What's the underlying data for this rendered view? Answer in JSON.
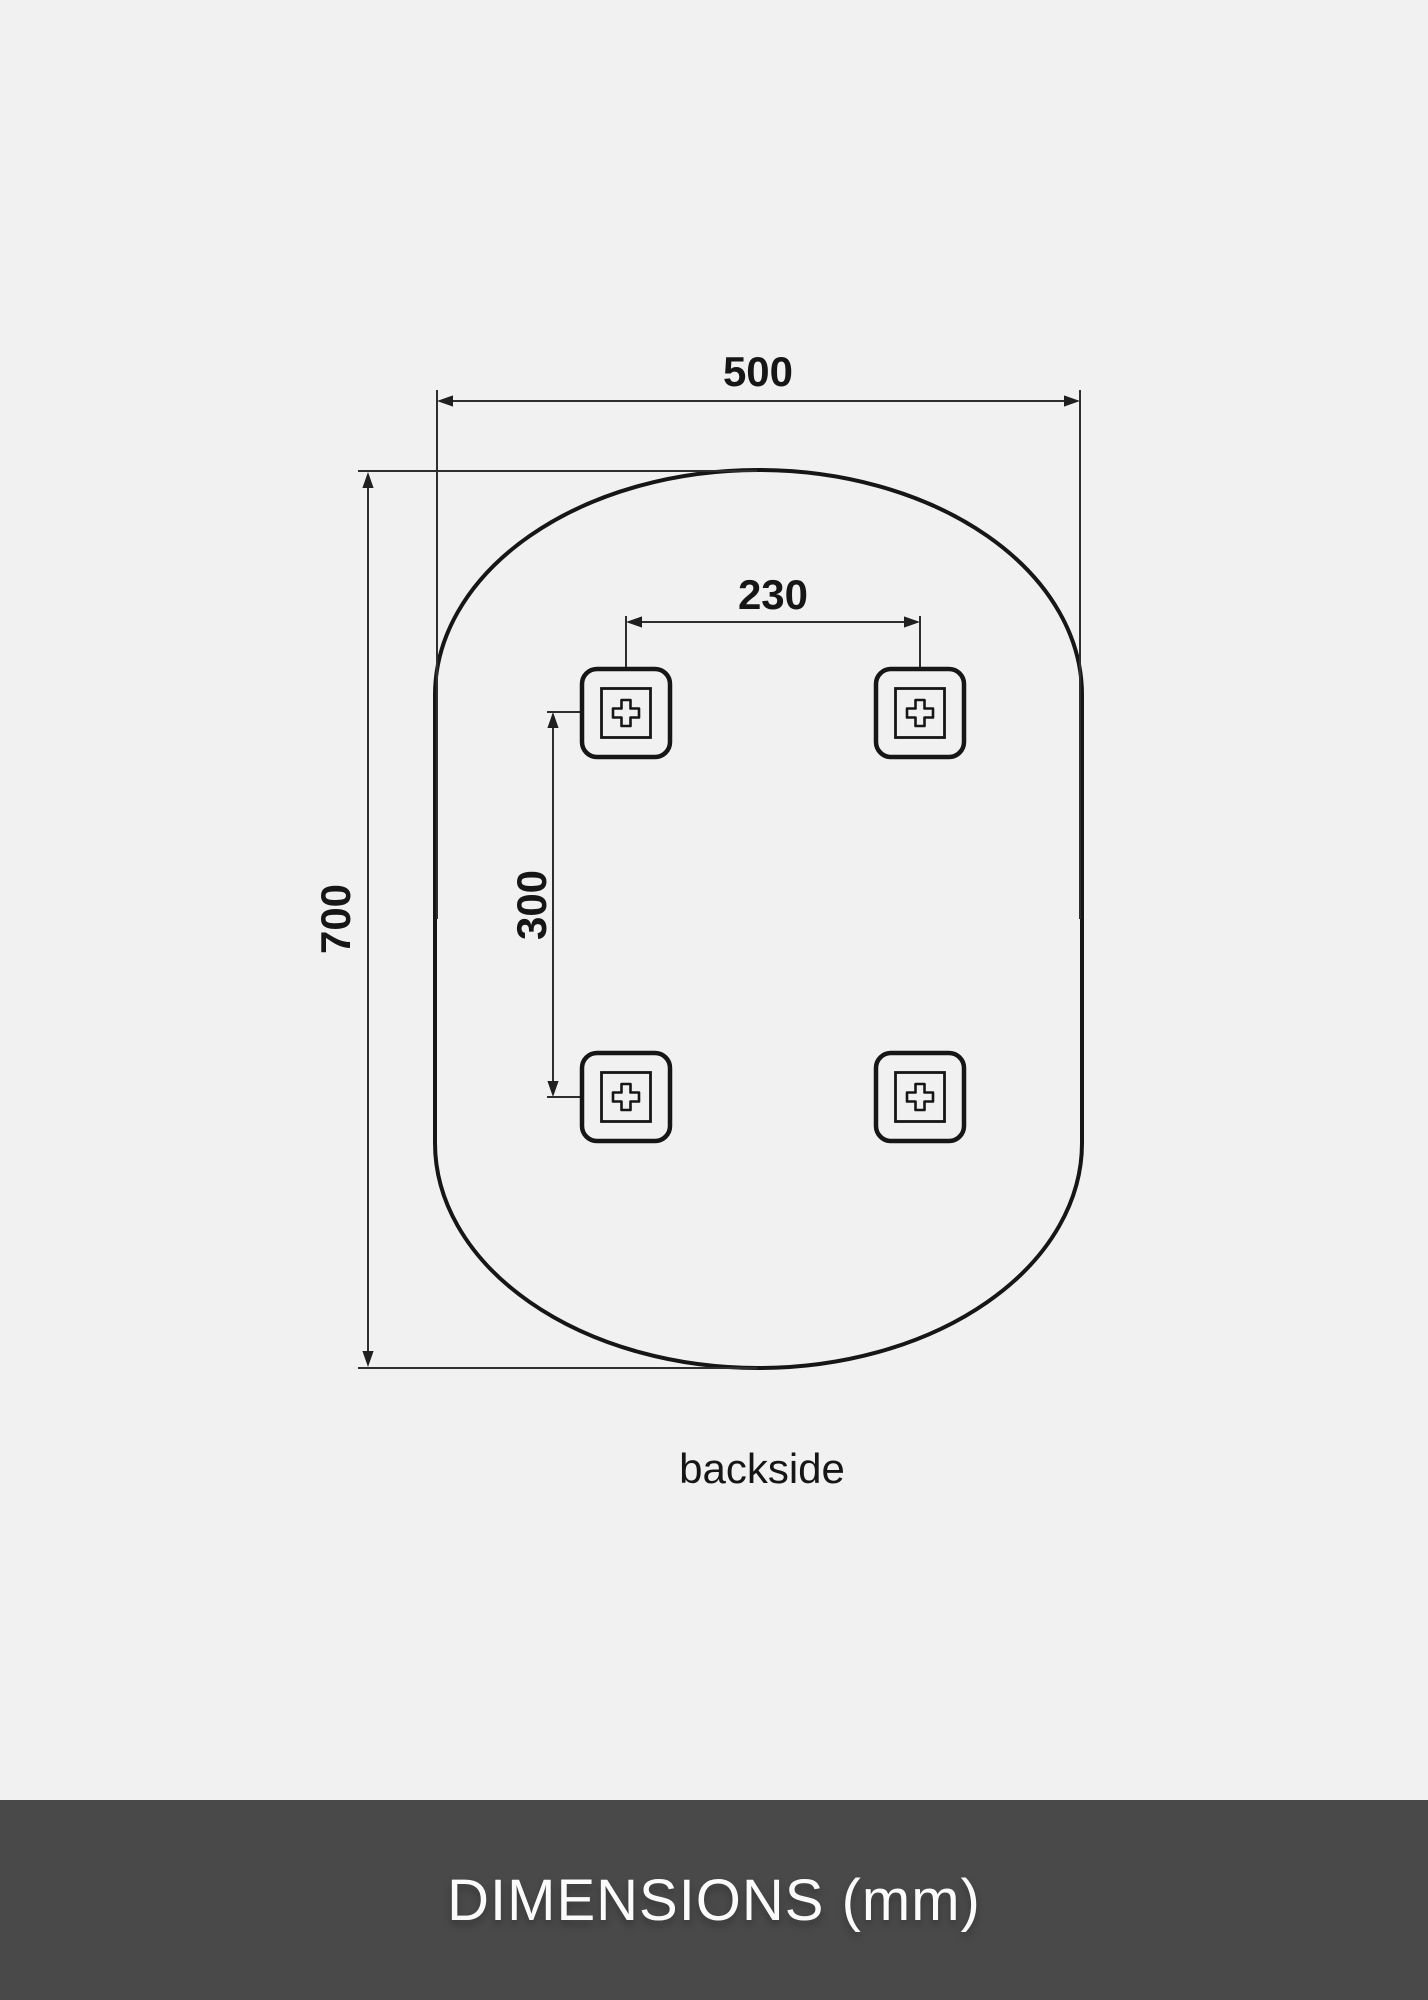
{
  "diagram": {
    "caption": "backside",
    "dimensions": {
      "width_label": "500",
      "height_label": "700",
      "hole_spacing_horizontal_label": "230",
      "hole_spacing_vertical_label": "300",
      "unit": "mm"
    },
    "colors": {
      "background": "#f1f1f2",
      "outline": "#161616",
      "dimension_lines": "#2e2e2e",
      "footer_background": "#494949",
      "footer_text": "#fbfbfb"
    }
  },
  "footer": {
    "title": "DIMENSIONS (mm)"
  }
}
